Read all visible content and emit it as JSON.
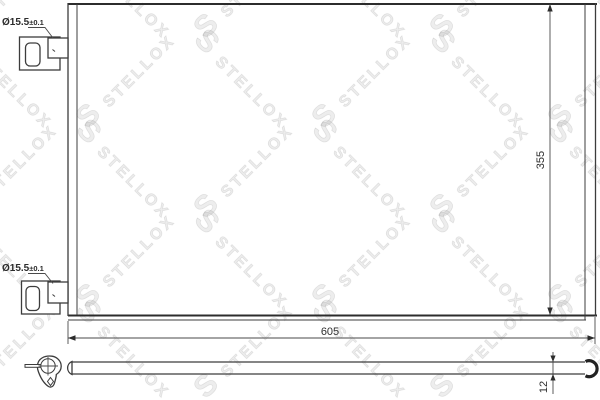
{
  "canvas": {
    "width": 600,
    "height": 400,
    "background": "#ffffff",
    "line_color": "#3c3c3c",
    "watermark_color": "#e2e2e2"
  },
  "watermark": {
    "text": "STELLOX",
    "logo_glyph": "S"
  },
  "views": {
    "front": {
      "dim_width": {
        "value": "605"
      },
      "dim_height": {
        "value": "355"
      },
      "port_top": {
        "diameter": "Ø15.5",
        "tolerance": "±0.1"
      },
      "port_bottom": {
        "diameter": "Ø15.5",
        "tolerance": "±0.1"
      }
    },
    "side": {
      "dim_depth": {
        "value": "12"
      }
    }
  }
}
